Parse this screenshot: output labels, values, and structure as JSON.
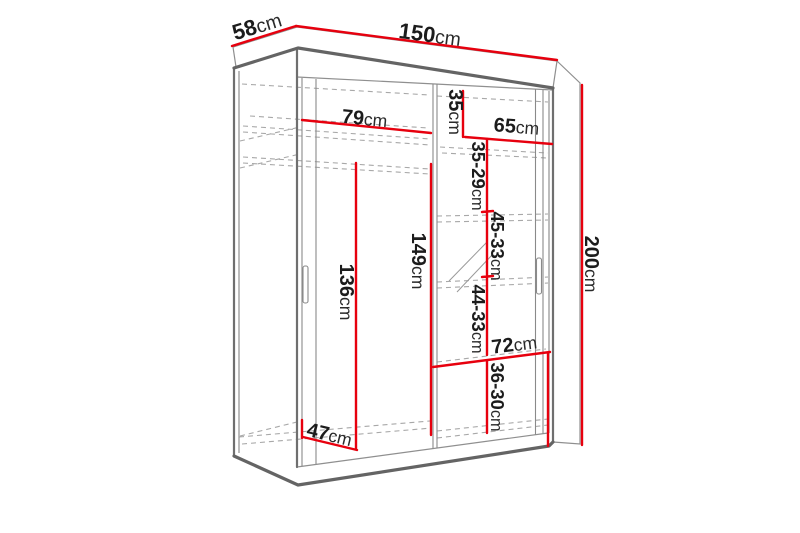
{
  "page": {
    "background": "#ffffff"
  },
  "diagram": {
    "type": "furniture-dimension-diagram",
    "subject": "two-door sliding wardrobe with interior shelves, hanging rail and mirror",
    "accent_color": "#e7000e",
    "outline_color": "#666666",
    "dashed_color": "#a8a8a8",
    "label_color": "#1c1c1c",
    "dims": {
      "depth": {
        "value": "58",
        "unit": "cm"
      },
      "width": {
        "value": "150",
        "unit": "cm"
      },
      "height": {
        "value": "200",
        "unit": "cm"
      },
      "left_section_width": {
        "value": "79",
        "unit": "cm"
      },
      "top_shelf_drop": {
        "value": "35",
        "unit": "cm"
      },
      "right_section_width": {
        "value": "65",
        "unit": "cm"
      },
      "gap_35_29": {
        "value": "35-29",
        "unit": "cm"
      },
      "gap_45_33": {
        "value": "45-33",
        "unit": "cm"
      },
      "hang_height": {
        "value": "136",
        "unit": "cm"
      },
      "interior_height": {
        "value": "149",
        "unit": "cm"
      },
      "gap_44_33": {
        "value": "44-33",
        "unit": "cm"
      },
      "bottom_section_width": {
        "value": "72",
        "unit": "cm"
      },
      "gap_36_30": {
        "value": "36-30",
        "unit": "cm"
      },
      "interior_depth": {
        "value": "47",
        "unit": "cm"
      }
    }
  }
}
